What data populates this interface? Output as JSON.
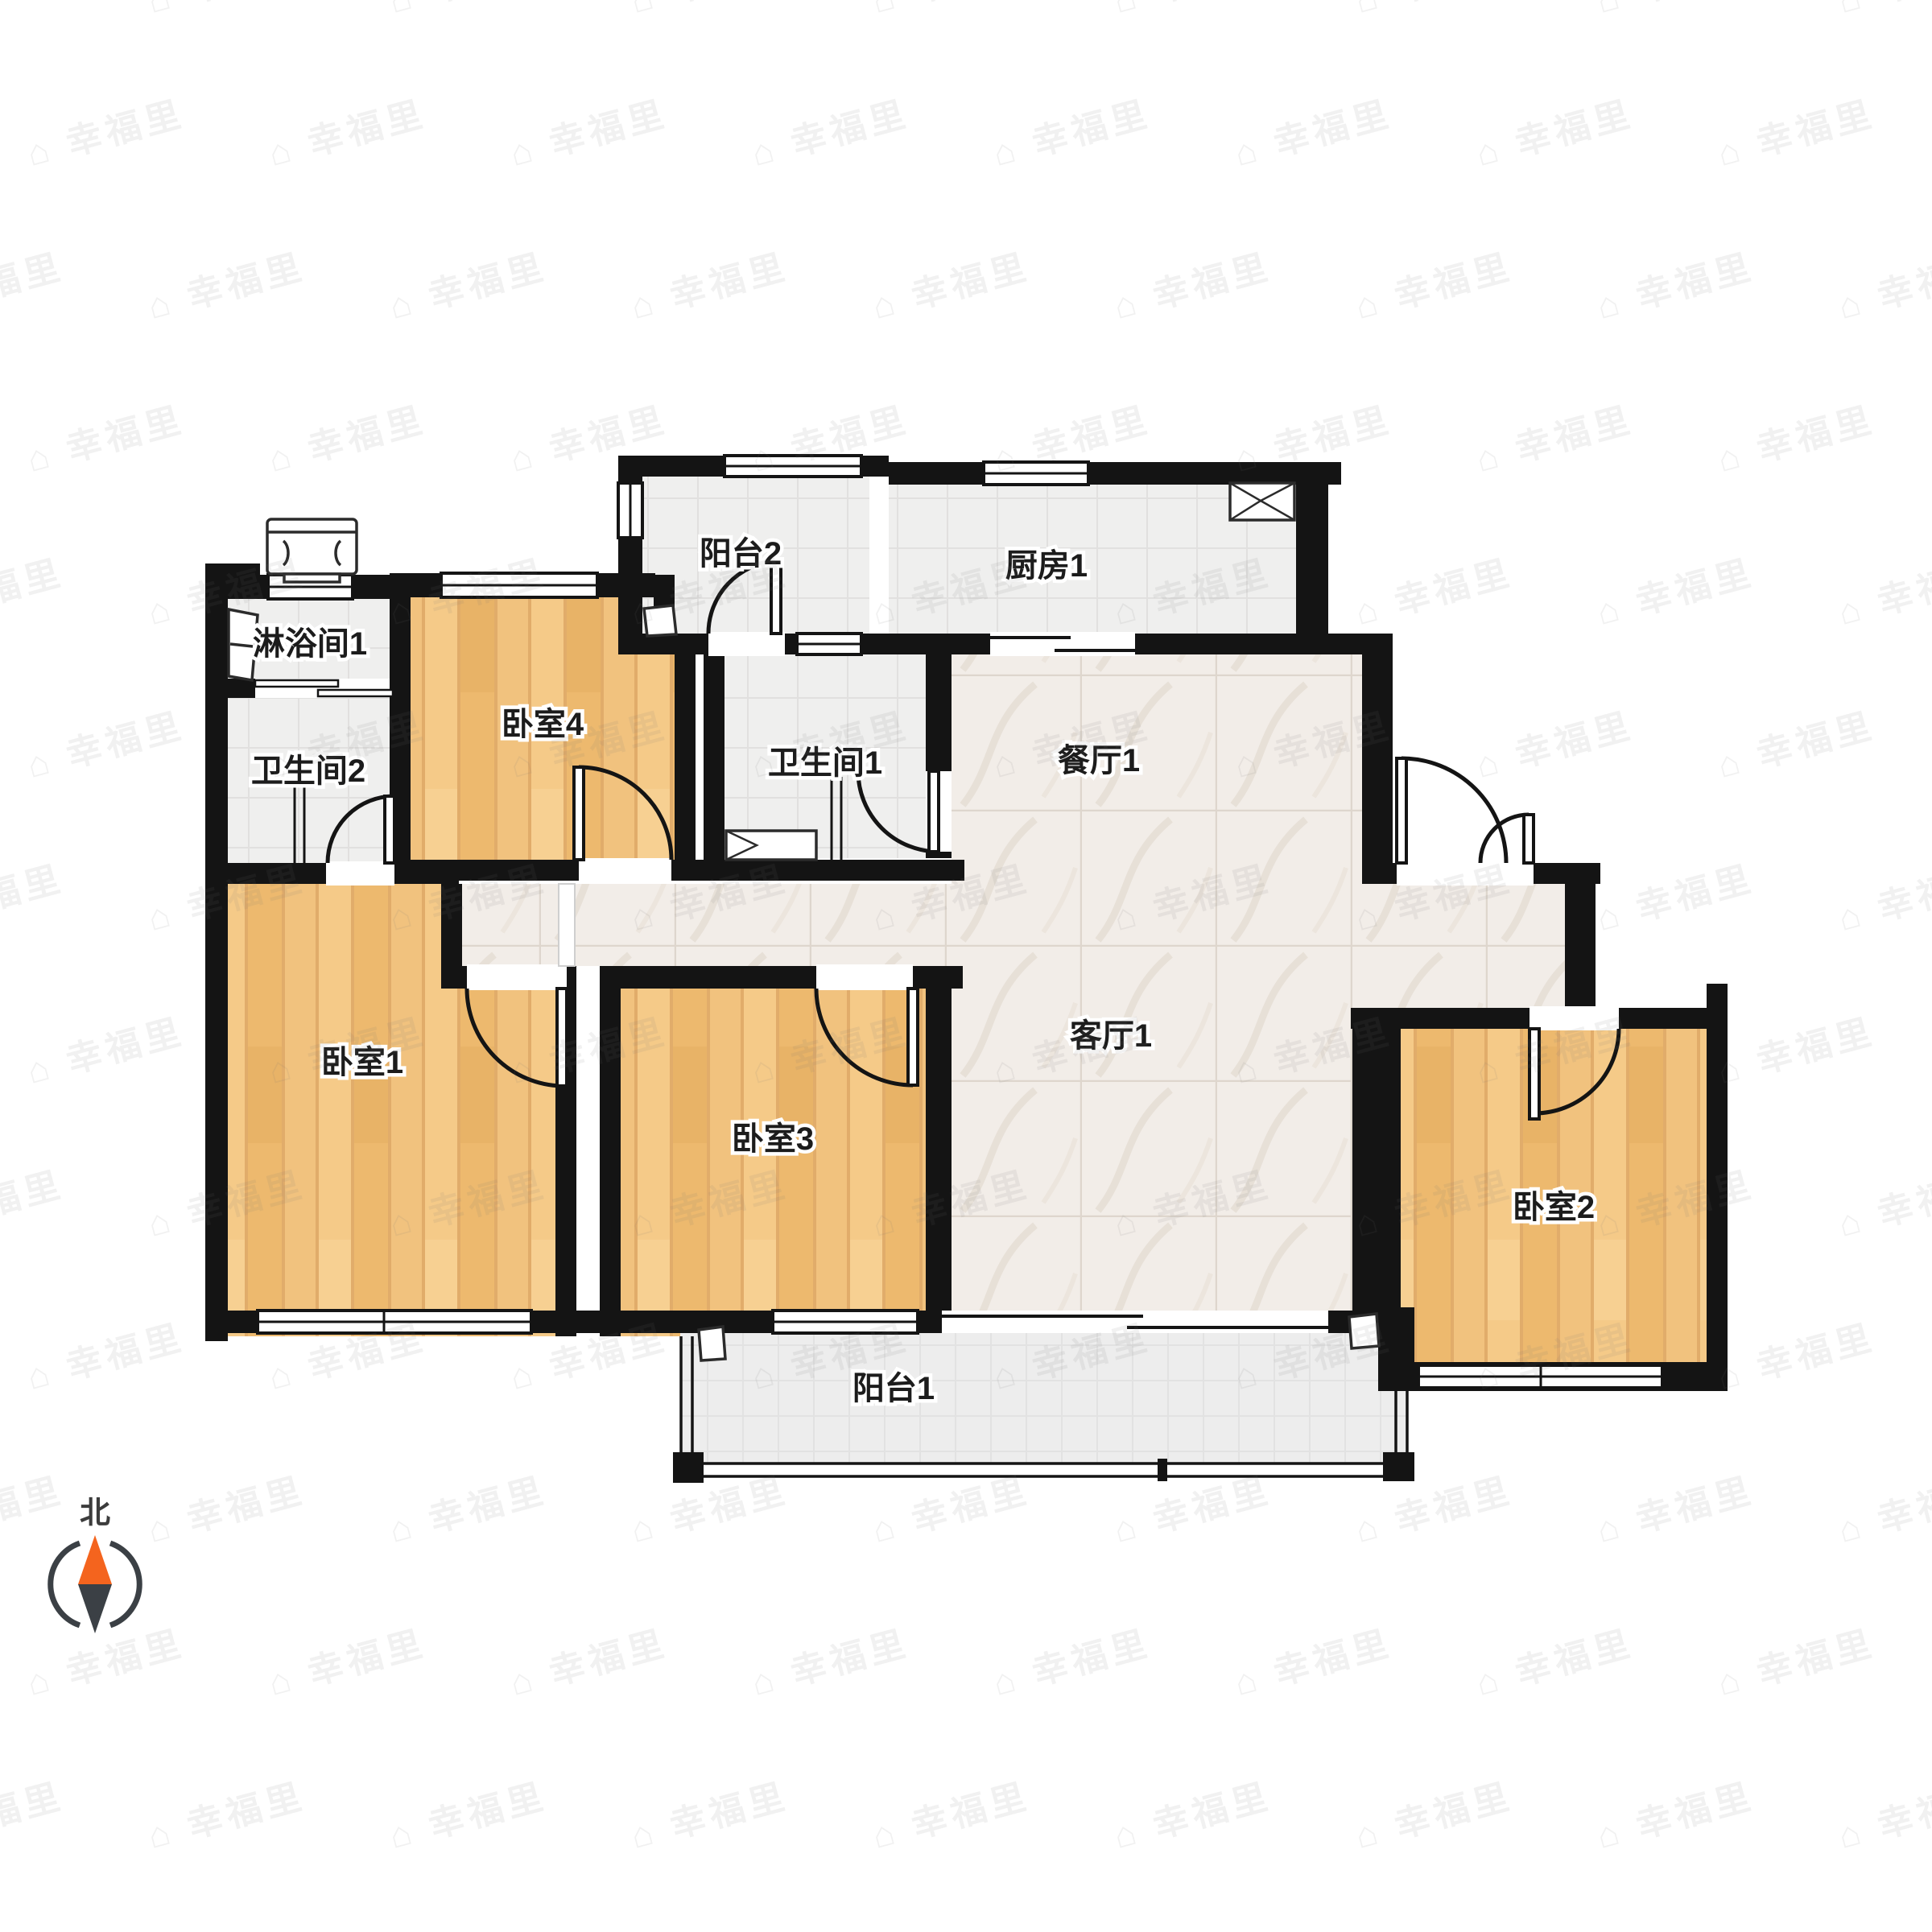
{
  "page": {
    "type": "apartment-floor-plan",
    "source_app_watermark": "幸福里"
  },
  "rooms": [
    {
      "id": "shower-room-1",
      "label": "淋浴间1",
      "floor": "tile"
    },
    {
      "id": "bathroom-2",
      "label": "卫生间2",
      "floor": "tile"
    },
    {
      "id": "bedroom-4",
      "label": "卧室4",
      "floor": "wood"
    },
    {
      "id": "balcony-2",
      "label": "阳台2",
      "floor": "tile"
    },
    {
      "id": "kitchen-1",
      "label": "厨房1",
      "floor": "tile"
    },
    {
      "id": "bathroom-1",
      "label": "卫生间1",
      "floor": "tile"
    },
    {
      "id": "dining-room-1",
      "label": "餐厅1",
      "floor": "marble"
    },
    {
      "id": "living-room-1",
      "label": "客厅1",
      "floor": "marble"
    },
    {
      "id": "bedroom-1",
      "label": "卧室1",
      "floor": "wood"
    },
    {
      "id": "bedroom-3",
      "label": "卧室3",
      "floor": "wood"
    },
    {
      "id": "bedroom-2",
      "label": "卧室2",
      "floor": "wood"
    },
    {
      "id": "balcony-1",
      "label": "阳台1",
      "floor": "tile"
    }
  ],
  "compass": {
    "north_label": "北"
  },
  "watermark": {
    "text": "幸福里",
    "icon": "house"
  },
  "colors": {
    "wall": "#141414",
    "wood": "#f2c07a",
    "wood_dark": "#edb96e",
    "tile": "#efefee",
    "marble": "#f2ede8",
    "balcony_tile": "#ededed",
    "compass_north": "#f4641e",
    "compass_south": "#3b4045"
  }
}
